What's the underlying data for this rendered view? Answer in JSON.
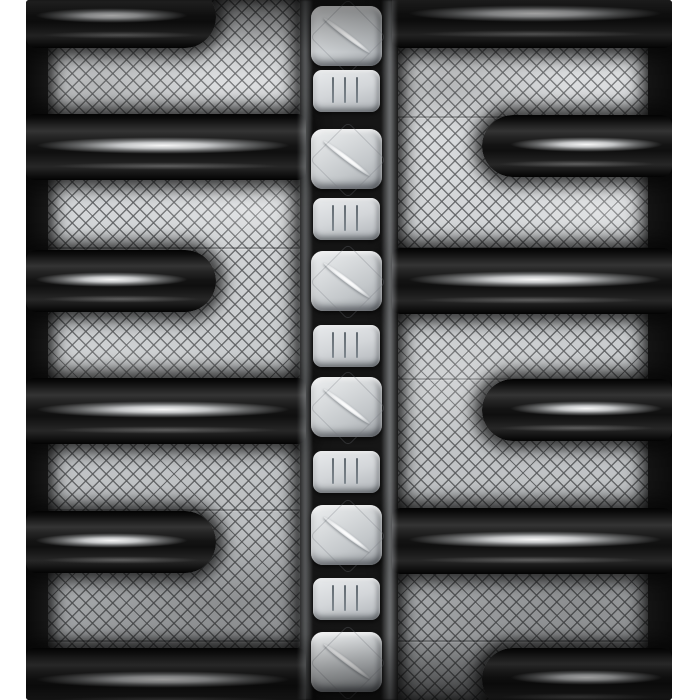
{
  "meta": {
    "description": "Close-up product photo of a black rubber track: staggered glossy C-pattern tread lugs on both sides, diamond cross-hatched silver tread base, and a center column of drive-lug blocks (large scratched squares alternating with small tick-marked pads) on a white background"
  },
  "palette": {
    "background_white": "#ffffff",
    "rubber_black": "#141414",
    "rubber_gloss_highlight": "#e9ebec",
    "tread_base_silver": "#cdd0d2",
    "hatch_line_gray": "#5f6163",
    "block_face_silver": "#d3d6d9",
    "scratch_mark_white": "#f8f8f8",
    "tick_mark_gray": "#4a545c"
  },
  "track": {
    "body": {
      "x": 26,
      "y": 0,
      "w": 646,
      "h": 700
    },
    "panels": {
      "left": {
        "x": 48,
        "w": 252
      },
      "right": {
        "x": 398,
        "w": 250
      }
    },
    "lug_groups": [
      {
        "name": "tread-lug-left-long",
        "x": 26,
        "w": 280,
        "h": 66,
        "cap": "none",
        "shine": [
          3,
          5
        ],
        "tops": [
          114,
          378,
          648
        ]
      },
      {
        "name": "tread-lug-left-short",
        "x": 26,
        "w": 190,
        "h": 62,
        "cap": "right",
        "shine": [
          4,
          14
        ],
        "tops": [
          -14,
          250,
          511
        ]
      },
      {
        "name": "tread-lug-right-long",
        "x": 392,
        "w": 280,
        "h": 66,
        "cap": "none",
        "shine": [
          5,
          3
        ],
        "tops": [
          -18,
          248,
          508
        ]
      },
      {
        "name": "tread-lug-right-short",
        "x": 482,
        "w": 190,
        "h": 62,
        "cap": "left",
        "shine": [
          14,
          4
        ],
        "tops": [
          115,
          379,
          648
        ]
      }
    ],
    "blocks": {
      "large": {
        "x": 311,
        "w": 71,
        "h": 60,
        "tops": [
          6,
          129,
          251,
          377,
          505,
          632
        ]
      },
      "small": {
        "x": 313,
        "w": 67,
        "h": 42,
        "tops": [
          70,
          198,
          325,
          451,
          578
        ],
        "tick_lefts": [
          28,
          46,
          64
        ]
      }
    }
  }
}
